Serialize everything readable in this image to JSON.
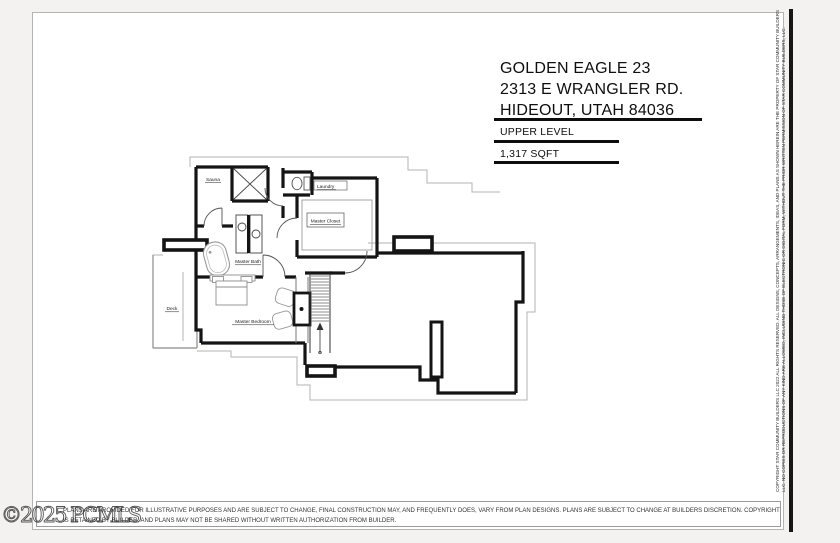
{
  "colors": {
    "ink": "#161616",
    "underlay": "#b3b3b1",
    "sheet_border": "#b5b4b2"
  },
  "title_block": {
    "line1": "GOLDEN EAGLE 23",
    "line2": "2313 E WRANGLER RD.",
    "line3": "HIDEOUT, UTAH 84036",
    "level": "UPPER LEVEL",
    "area": "1,317 SQFT"
  },
  "plan": {
    "rooms": {
      "sauna": "Sauna",
      "laundry": "Laundry",
      "master_closet": "Master Closet",
      "master_bath": "Master Bath",
      "deck": "Deck",
      "master_bedroom": "Master Bedroom"
    }
  },
  "sidebar_copyright": {
    "line1": "COPYRIGHT STAR COMMUNITY BUILDERS LLC 2022 ALL RIGHTS RESERVED. ALL DESIGNS, CONCEPTS, ARRANGEMENTS, IDEAS, AND PLANS AS SHOWN HEREIN ARE THE PROPERTY OF STAR COMMUNITY BUILDERS",
    "line2": "LLC. NO COPIES OR REPRODUCTIONS OF ANY KIND ARE ALLOWED, INCLUDING THOSE OF ELECTRONIC OR DIGITAL FORM, WITHOUT THE PRIOR WRITTEN PERMISSION OF STAR COMMUNITY BUILDERS, LLC."
  },
  "disclaimer": {
    "line1": "PLANS ARE PROVIDED FOR ILLUSTRATIVE PURPOSES AND ARE SUBJECT TO CHANGE, FINAL CONSTRUCTION MAY, AND FREQUENTLY DOES, VARY FROM PLAN DESIGNS. PLANS ARE SUBJECT TO CHANGE AT BUILDERS DISCRETION. COPYRIGHT TO PLANS",
    "line2": "IS RETAINED BY BUILDER, AND PLANS MAY NOT BE SHARED WITHOUT WRITTEN AUTHORIZATION FROM BUILDER."
  },
  "watermark": "©2025 PCMLS"
}
